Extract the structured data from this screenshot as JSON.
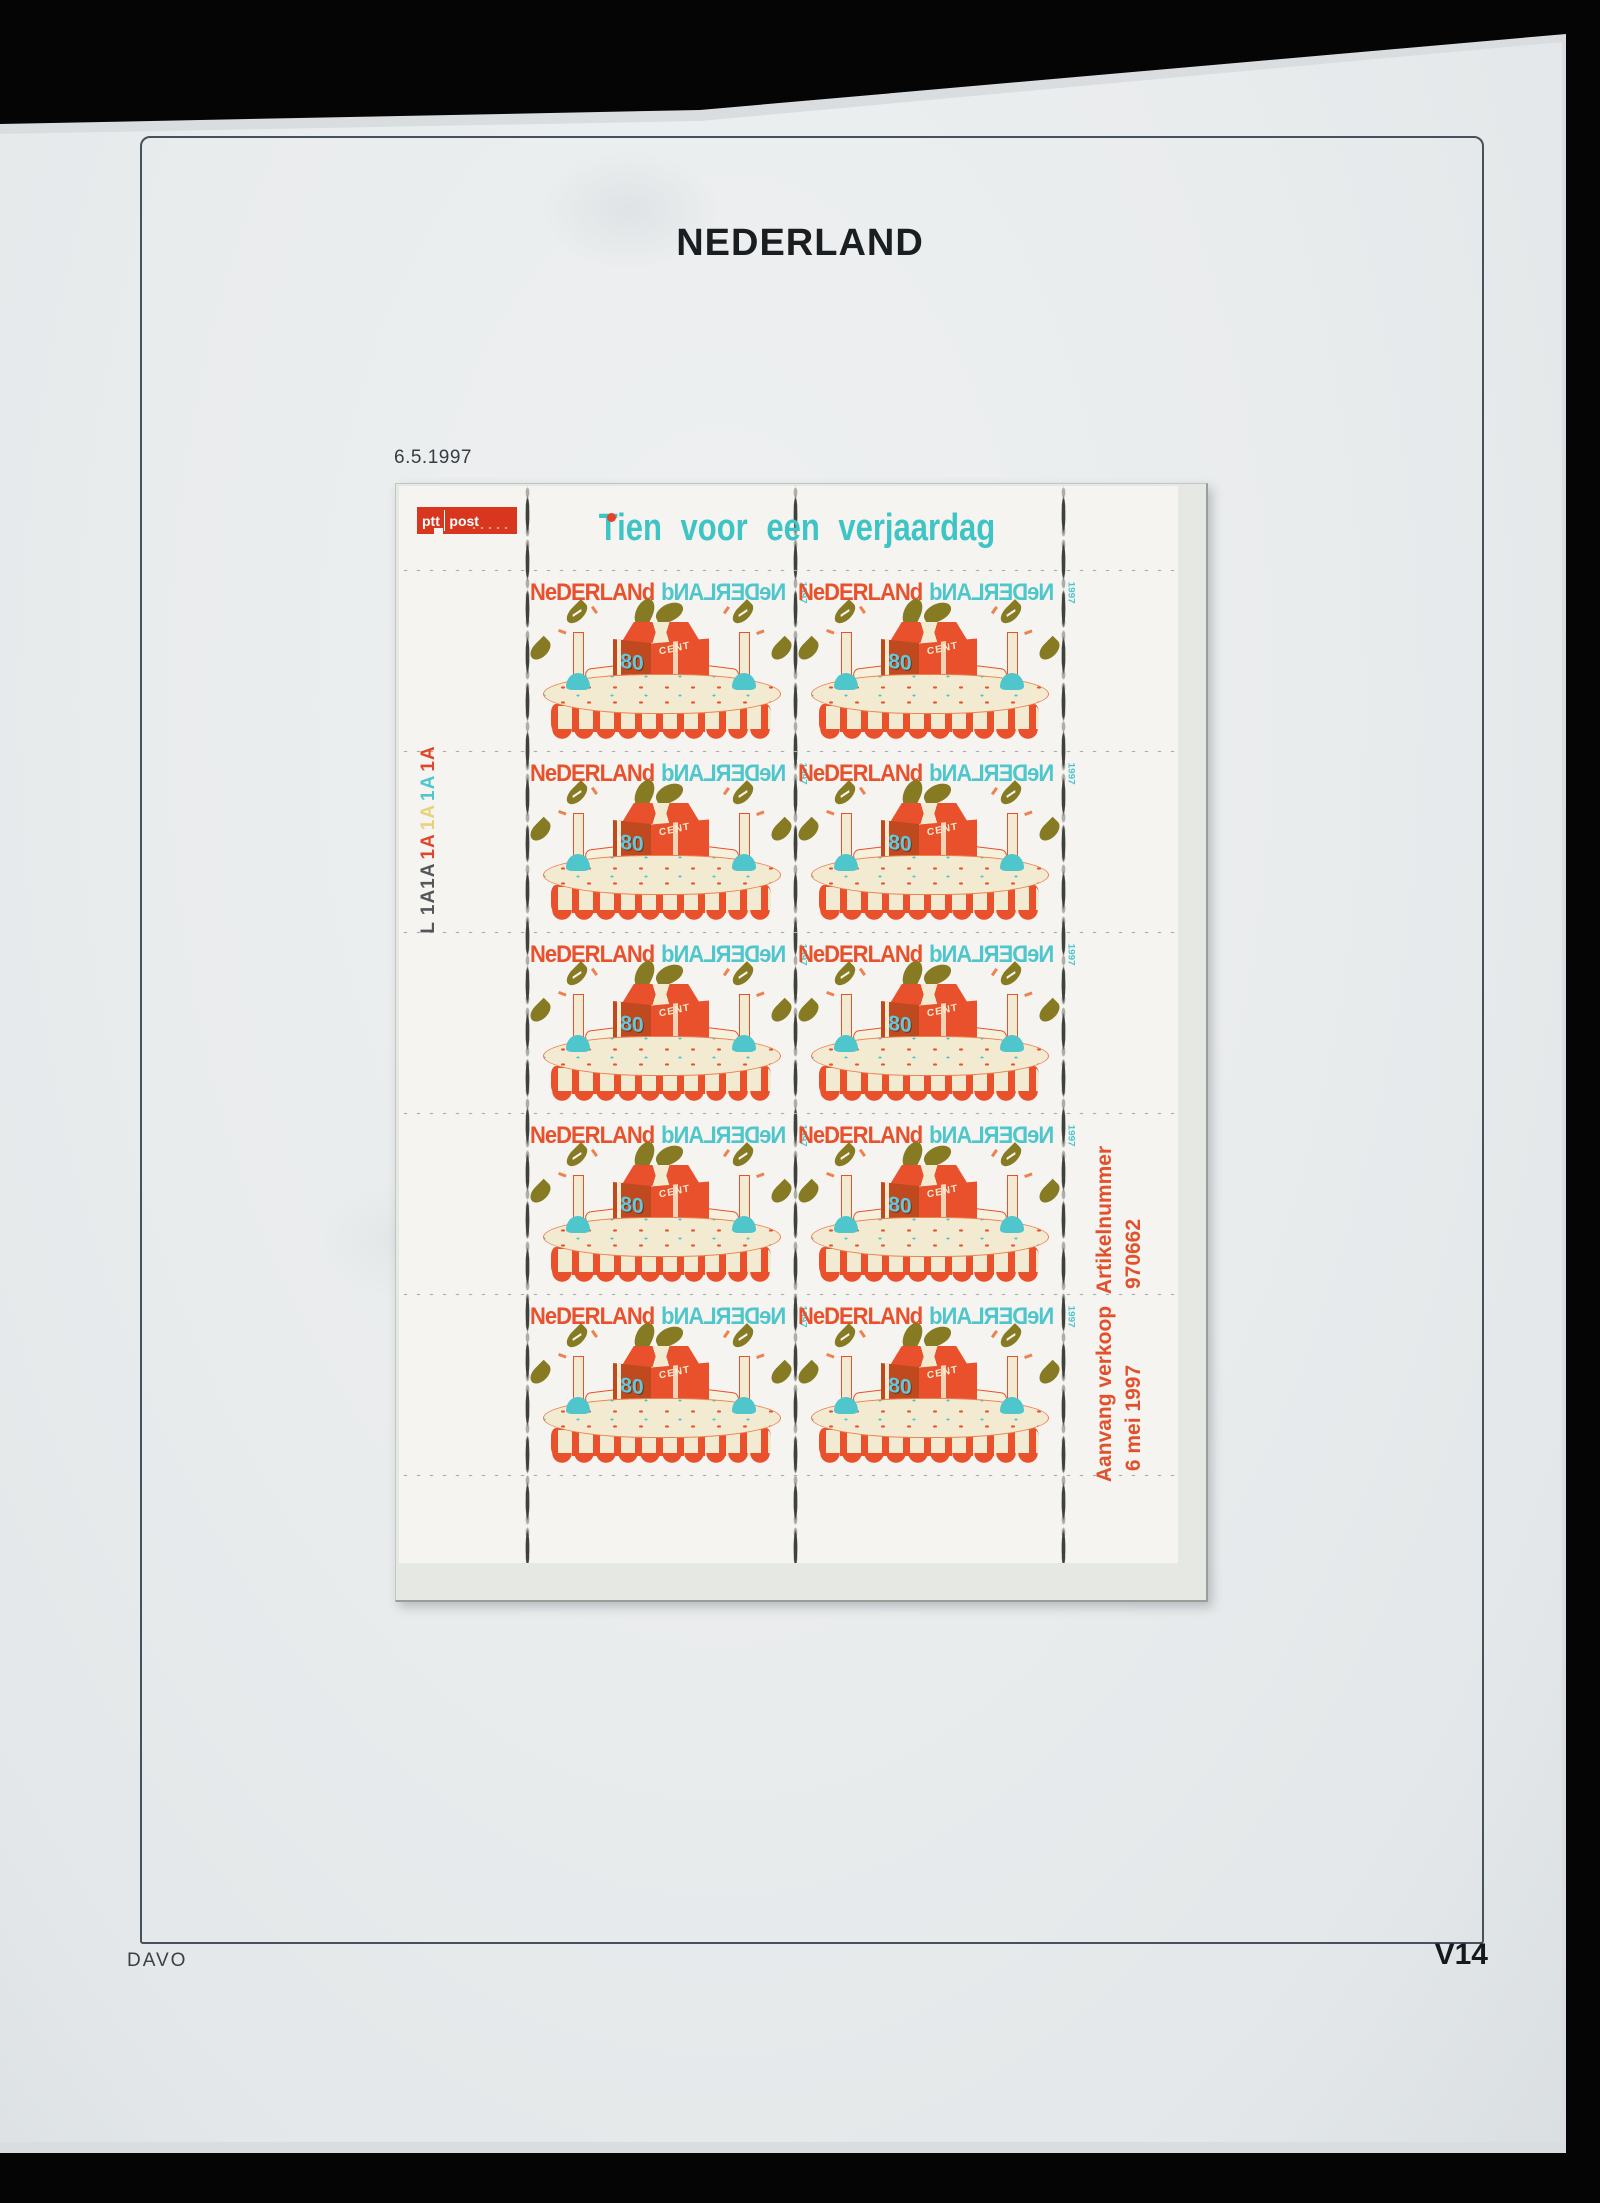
{
  "page": {
    "album_title": "NEDERLAND",
    "date_label": "6.5.1997",
    "publisher": "DAVO",
    "page_code": "V14"
  },
  "sheet": {
    "logo": {
      "ptt": "ptt",
      "post": "post"
    },
    "header_title": "Tien voor een verjaardag",
    "plate_marking": {
      "parts": [
        {
          "text": "L 1A1A",
          "color": "#55565a"
        },
        {
          "text": "1A",
          "color": "#e0472a"
        },
        {
          "text": "1A",
          "color": "#e6d27a"
        },
        {
          "text": "1A",
          "color": "#4fc6ce"
        },
        {
          "text": "1A",
          "color": "#e0472a"
        }
      ]
    },
    "margin": {
      "article_label": "Artikelnummer",
      "article_number": "970662",
      "sale_label": "Aanvang verkoop",
      "sale_date": "6 mei 1997"
    },
    "stamp": {
      "country": "NeDERLANd",
      "year": "1997",
      "value": "80",
      "currency": "CENT"
    },
    "grid": {
      "rows": 5,
      "cols": 2
    }
  },
  "colors": {
    "stamp_red": "#e8512b",
    "stamp_teal": "#4ec6cc",
    "stamp_olive": "#867a22",
    "stamp_cream": "#f2ebd1",
    "logo_red": "#d93620",
    "sheet_white": "#f5f4f1",
    "page_gray": "#e9eced"
  }
}
